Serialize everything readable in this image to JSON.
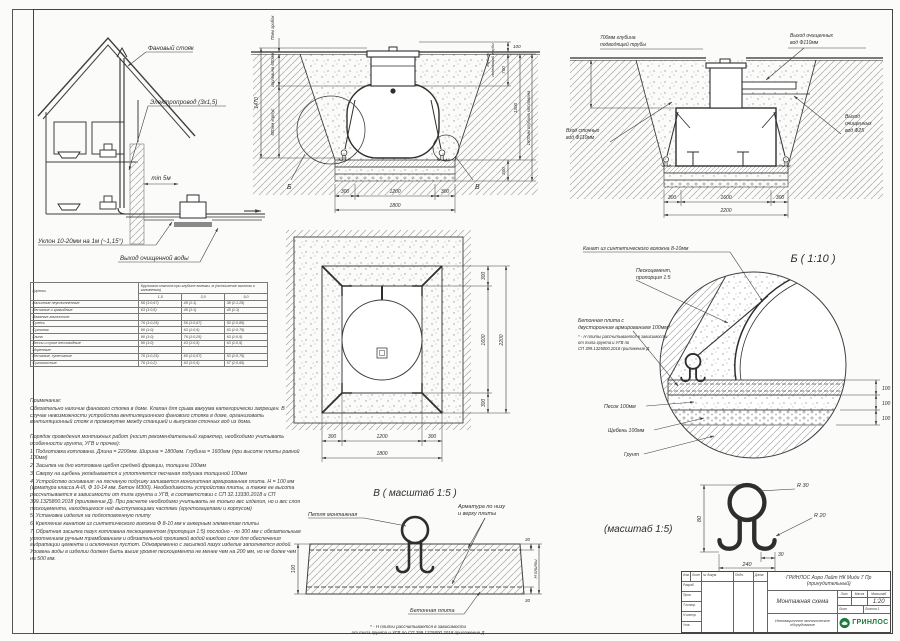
{
  "house": {
    "vent": "Фановый стояк",
    "electric": "Электропровод (3х1,5)",
    "min5": "min 5м",
    "slope": "Уклон 10-20мм на 1м (~1,15°)",
    "outlet": "Выход очищенной воды"
  },
  "sectionA": {
    "b": "Б",
    "v": "В",
    "lid70": "70мм грибок",
    "neck600": "горловина 600мм",
    "body800": "800мм корпус",
    "total1470": "1470",
    "pipe_l1": "глубина",
    "pipe_l2": "подводящей трубы",
    "d100": "100",
    "d700": "700",
    "d1300": "1300",
    "d300": "300",
    "depth1600": "1600мм глубина котлована",
    "b300l": "300",
    "b1200": "1200",
    "b300r": "300",
    "b1800": "1800"
  },
  "sectionC": {
    "pipe1": "700мм глубина",
    "pipe2": "подводящей трубы",
    "out110_1": "Выход очищенных",
    "out110_2": "вод Ф110мм",
    "out25_1": "Выход",
    "out25_2": "очищенных",
    "out25_3": "вод Ф25",
    "in110_1": "Вход сточных",
    "in110_2": "вод Ф110мм",
    "d300l": "300",
    "d1600": "1600",
    "d300r": "300",
    "d2200": "2200"
  },
  "plan": {
    "r300t": "300",
    "r1600": "1600",
    "r300b": "300",
    "r2200": "2200",
    "b300l": "300",
    "b1200": "1200",
    "b300r": "300",
    "b1800": "1800"
  },
  "detailB": {
    "title": "Б ( 1:10 )",
    "rope": "Канат из синтетического волокна 8-10мм",
    "sc1": "Пескоцемент,",
    "sc2": "пропорция 1:5",
    "slab1": "Бетонная плита с",
    "slab2": "двусторонним армированием 100мм*",
    "fn1": "* - Н плиты рассчитывается в зависимости",
    "fn2": "от типа грунта и УГВ по",
    "fn3": "СП 399.1325800.2018 приложение Д",
    "sand": "Песок 100мм",
    "gravel": "Щебень 100мм",
    "soil": "Грунт",
    "d1": "100",
    "d2": "100",
    "d3": "100"
  },
  "detailV": {
    "title": "В ( масштаб 1:5 )",
    "loop": "Петля монтажная",
    "reb1": "Арматура по низу",
    "reb2": "и верху плиты",
    "slab": "Бетонная плита",
    "d100": "100",
    "d30t": "30",
    "d30b": "30",
    "hpl": "Н плиты",
    "fn1": "* - Н плиты рассчитывается в зависимости",
    "fn2": "от типа грунта и УГВ по СП 399.1325800.2018 приложение Д"
  },
  "loopd": {
    "title": "(масштаб 1:5)",
    "r30": "R 30",
    "r20": "R 20",
    "d80": "80",
    "d30": "30",
    "d240": "240"
  },
  "soil_table": {
    "col_soils": "Грунты",
    "hdr1": "Крутизна откосов при глубине выемки, м",
    "hdr2": "(отношение высоты к заложению)",
    "depths": [
      "1,5",
      "3,0",
      "5,0"
    ],
    "rows": [
      {
        "name": "Насыпные неуплотненные",
        "v1": "56 (1:0,67)",
        "v2": "45 (1:1)",
        "v3": "38 (1:1,25)"
      },
      {
        "name": "Песчаные и гравийные",
        "v1": "63 (1:0,5)",
        "v2": "45 (1:1)",
        "v3": "45 (1:1)"
      },
      {
        "name": "Влажные глинистые:",
        "v1": "",
        "v2": "",
        "v3": ""
      },
      {
        "name": "Супесь",
        "v1": "76 (1:0,25)",
        "v2": "56 (1:0,67)",
        "v3": "50 (1:0,85)"
      },
      {
        "name": "Суглинок",
        "v1": "90 (1:0)",
        "v2": "63 (1:0,5)",
        "v3": "53 (1:0,75)"
      },
      {
        "name": "Глина",
        "v1": "90 (1:0)",
        "v2": "76 (1:0,25)",
        "v3": "63 (1:0,5)"
      },
      {
        "name": "Лессы и сухие лессовидные",
        "v1": "90 (1:0)",
        "v2": "63 (1:0,5)",
        "v3": "63 (1:0,5)"
      },
      {
        "name": "Моренные:",
        "v1": "",
        "v2": "",
        "v3": ""
      },
      {
        "name": "Песчаные, супесчаные",
        "v1": "76 (1:0,25)",
        "v2": "60 (1:0,57)",
        "v3": "53 (1:0,75)"
      },
      {
        "name": "Суглинистые",
        "v1": "76 (1:0,2)",
        "v2": "63 (1:0,5)",
        "v3": "57 (1:0,65)"
      }
    ]
  },
  "notes": {
    "title": "Примечание:",
    "p1": "Обязательно наличие фанового стояка в доме. Клапан для срыва вакуума категорически запрещен. В случае невозможности устройства вентиляционного фанового стояка в доме, организовать вентиляционный стояк в промежутке между станцией и выпуском сточных вод из дома.",
    "order_title": "Порядок проведения монтажных работ (носит рекомендательный характер, необходимо учитывать особенности грунта, УГВ и прочее):",
    "steps": [
      "1. Подготовка котлована. Длина = 2200мм. Ширина = 1800мм. Глубина = 1600мм (при высоте плиты равной 100мм)",
      "2. Засыпка на дно котлована щебня средней фракции, толщина 100мм",
      "3. Сверху на щебень укладывается и уплотняется песчаная подушка толщиной 100мм",
      "4. Устройство основания: на песчаную подушку заливается монолитная армированная плита. Н = 100 мм (арматура класса А-III, Ф 10-14 мм. Бетон М300). Необходимость устройства плиты, а также ее высота рассчитывается в зависимости от типа грунта и УГВ, в соответствии с СП 32.13330.2018 и СП 399.1325800.2018 (приложение Д). При расчете необходимо учитывать не только вес изделия, но и вес слоя пескоцемента, находящегося над выступающими частями (грунтозацепами и корпусом)",
      "5. Установка изделия на подготовленную плиту",
      "6. Крепление канатом из синтетического волокна Ф 8-10 мм к анкерным элементам плиты",
      "7. Обратная засыпка пазух котлована пескоцементом (пропорция 1:5) послойно - по 300 мм с обязательным уплотнением ручным трамбованием и обязательной проливкой водой каждого слоя для обеспечения гидратации цемента и исключения пустот. Одновременно с засыпкой пазух изделие заполняется водой. Уровень воды в изделии должен быть выше уровня пескоцемента не менее чем на 200 мм, но не более чем на 500 мм."
    ]
  },
  "title_block": {
    "doc_name": "ГРИНЛОС Аэро Лайт НК Миди 7 Пр (принудительный)",
    "drawing_name": "Монтажная схема",
    "scale": "1:20",
    "lit": "Лит.",
    "mass": "Масса",
    "scale_label": "Масштаб",
    "sheet_label": "Лист",
    "sheets_label": "Листов",
    "sheets_value": "1",
    "company_line": "Инновационное экологическое оборудование",
    "brand": "ГРИНЛОС",
    "col_izm": "Изм.",
    "col_list": "Лист",
    "col_doc": "№ докум.",
    "col_sign": "Подп.",
    "col_date": "Дата",
    "row1": "Разраб.",
    "row2": "Пров.",
    "row3": "Т.контр.",
    "row4": "Н.контр.",
    "row5": "Утв."
  }
}
